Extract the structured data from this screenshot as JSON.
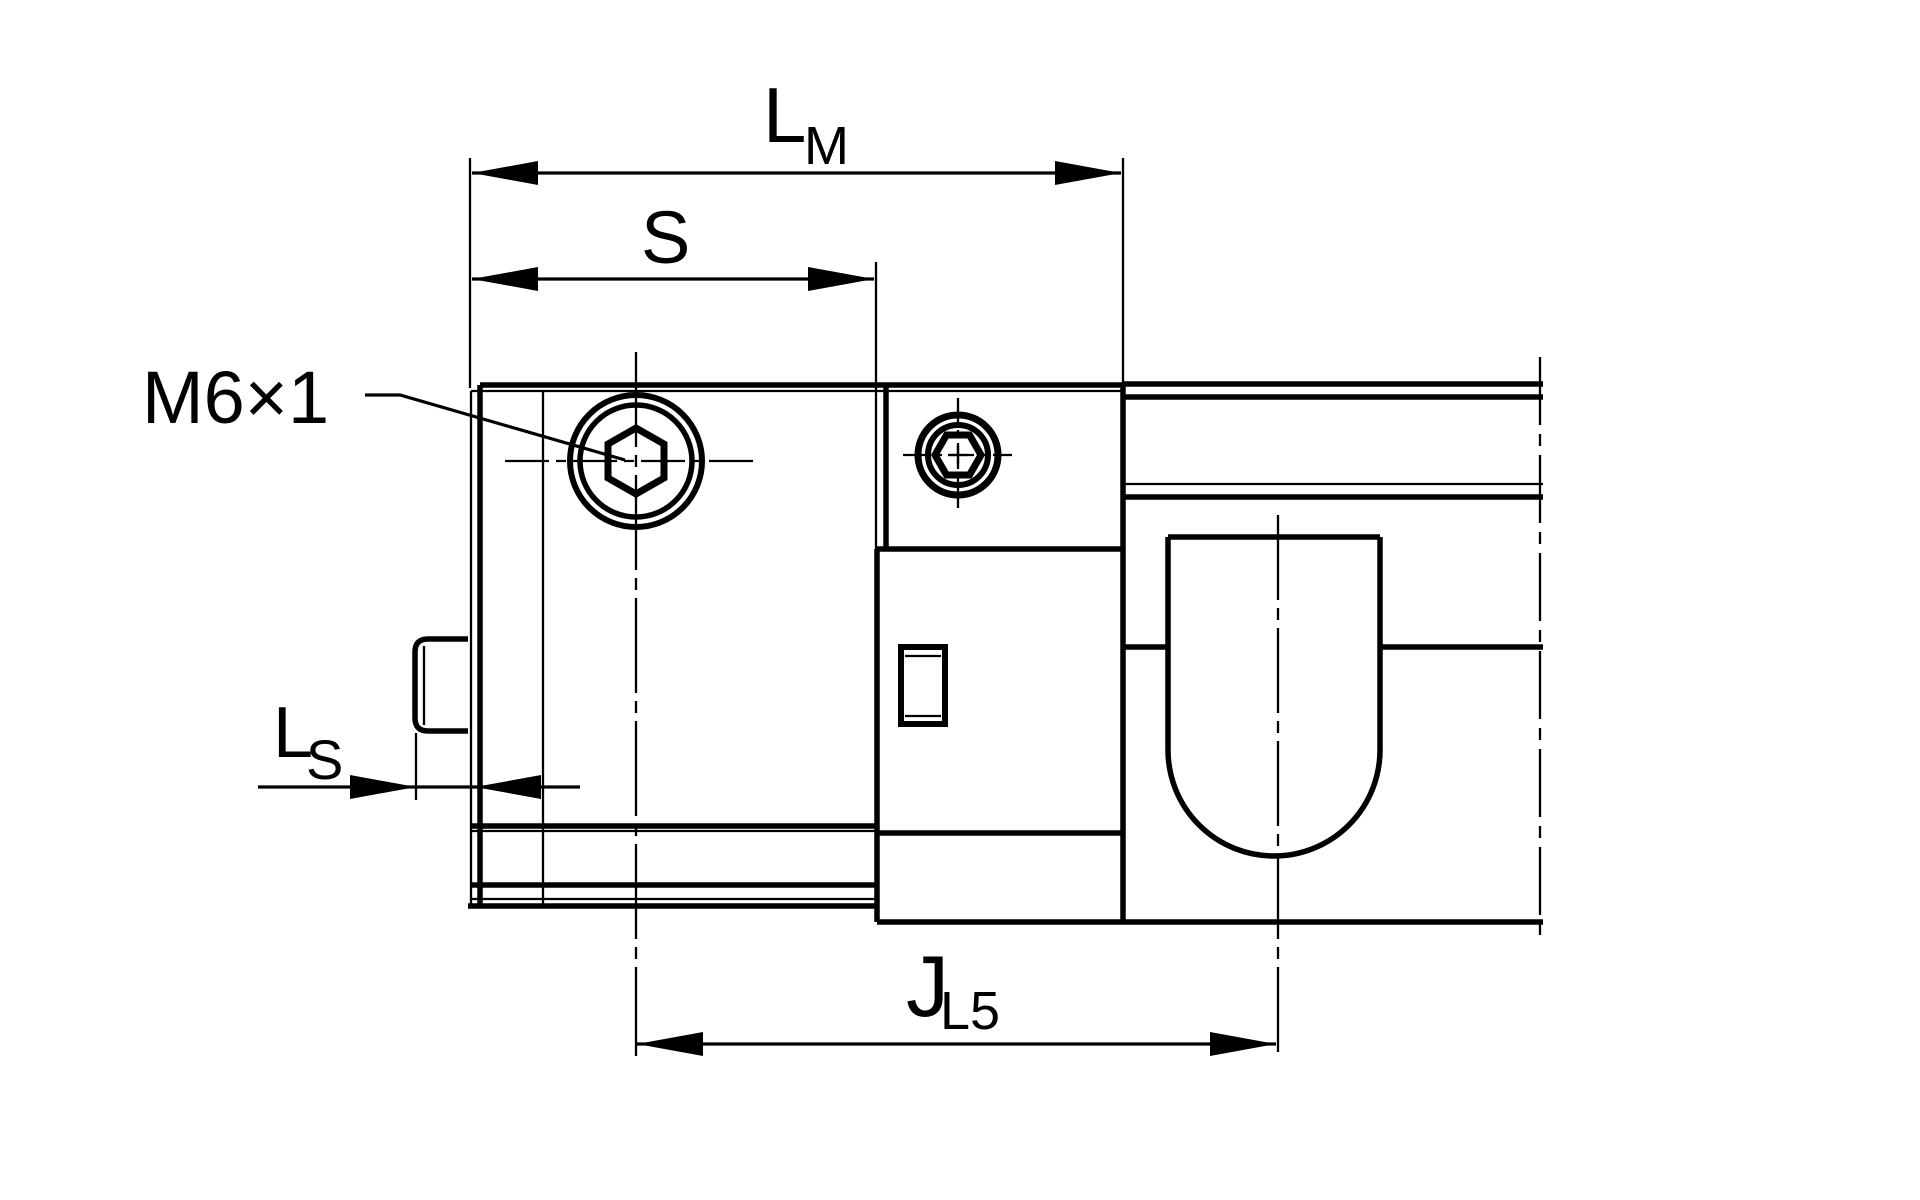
{
  "drawing": {
    "background_color": "#ffffff",
    "line_color": "#000000",
    "thread_callout": {
      "text": "M6×1"
    },
    "dimensions": {
      "lm": {
        "main": "L",
        "sub": "M"
      },
      "s": {
        "main": "S",
        "sub": ""
      },
      "ls": {
        "main": "L",
        "sub": "S"
      },
      "jl5": {
        "main": "J",
        "sub": "L5"
      }
    }
  }
}
